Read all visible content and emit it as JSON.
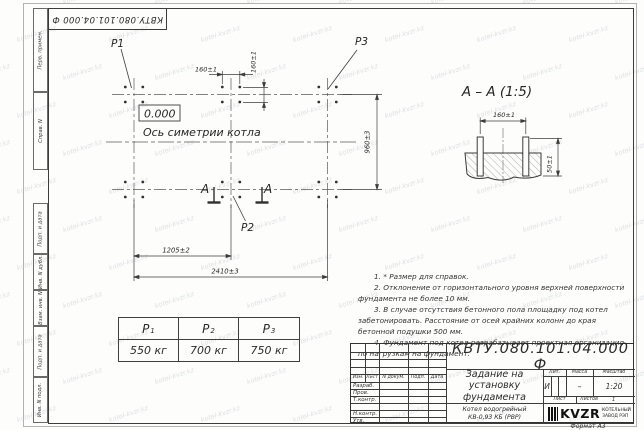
{
  "sheet": {
    "watermark": "kotel-kvzr.kz",
    "corner_stamp": "КВТУ.080.101.04.000 Ф",
    "format_label": "Формат А3"
  },
  "margin_strip": {
    "cells": [
      "Перв. примен.",
      "Справ. N",
      "Подп. и дата",
      "Инв. N дубл.",
      "Взам. инв. N",
      "Подп. и дата",
      "Инв. N подл."
    ]
  },
  "plan": {
    "point_labels": {
      "p1": "P1",
      "p2": "P2",
      "p3": "P3"
    },
    "level_mark": "0.000",
    "axis_label": "Ось симетрии котла",
    "section_letter": "A",
    "dims": {
      "bolt_x": "160±1",
      "bolt_y": "160±1",
      "row_span": "960±3",
      "col_half": "1205±2",
      "col_full": "2410±3"
    }
  },
  "section": {
    "title": "A – A (1:5)",
    "dims": {
      "bolt_spacing": "160±1",
      "protrusion": "50±1"
    }
  },
  "load_table": {
    "columns": [
      {
        "base": "P",
        "sub": "1",
        "value": "550 кг"
      },
      {
        "base": "P",
        "sub": "2",
        "value": "700 кг"
      },
      {
        "base": "P",
        "sub": "3",
        "value": "750 кг"
      }
    ]
  },
  "notes": {
    "items": [
      "1. * Размер для справок.",
      "2. Отклонение от горизонтального уровня верхней поверхности фундамента не более 10 мм.",
      "3. В случае отсутствия бетонного пола площадку под котел забетонировать. Расстояние от осей крайних колонн до края бетонной подушки 500 мм.",
      "4. Фундамент под котел разрабатывает проектная организация по нагрузкам на фундамент."
    ]
  },
  "title_block": {
    "doc_number": "КВТУ.080.101.04.000 Ф",
    "title_lines": [
      "Задание на",
      "установку",
      "фундамента"
    ],
    "product_lines": [
      "Котел водогрейный",
      "КВ-0,93 КБ (РВР)"
    ],
    "header_cols": [
      "Изм.",
      "Лист",
      "N докум.",
      "Подп.",
      "Дата"
    ],
    "row_labels": [
      "Разраб.",
      "Пров.",
      "Т.контр.",
      "",
      "Н.контр.",
      "Утв."
    ],
    "lit_label": "Лит.",
    "mass_label": "Масса",
    "scale_label": "Масштаб",
    "lit_value": "И",
    "mass_value": "–",
    "scale_value": "1:20",
    "sheet_label": "Лист",
    "sheets_label": "Листов",
    "sheets_value": "1",
    "company": {
      "logo_text": "KVZR",
      "tagline_lines": [
        "КОТЕЛЬНЫЙ",
        "ЗАВОД РЭП"
      ]
    }
  }
}
